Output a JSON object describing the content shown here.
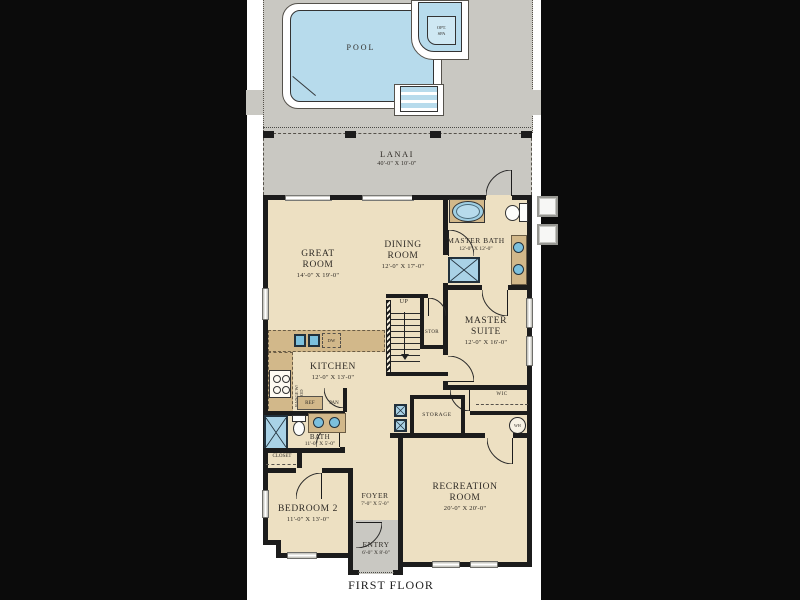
{
  "plan": {
    "title": "FIRST FLOOR"
  },
  "pool_area": {
    "pool_label": "POOL",
    "spa_label": "OPT. SPA"
  },
  "rooms": {
    "lanai": {
      "name": "LANAI",
      "dims": "40'-0\" X 10'-0\""
    },
    "great_room": {
      "name": "GREAT ROOM",
      "dims": "14'-0\" X 19'-0\""
    },
    "dining_room": {
      "name": "DINING ROOM",
      "dims": "12'-0\" X 17'-0\""
    },
    "master_bath": {
      "name": "MASTER BATH",
      "dims": "12'-0\" X 12'-0\""
    },
    "master_suite": {
      "name": "MASTER SUITE",
      "dims": "12'-0\" X 16'-0\""
    },
    "kitchen": {
      "name": "KITCHEN",
      "dims": "12'-0\" X 13'-0\""
    },
    "bath": {
      "name": "BATH",
      "dims": "11'-0\" X 5'-0\""
    },
    "bedroom2": {
      "name": "BEDROOM 2",
      "dims": "11'-0\" X 13'-0\""
    },
    "foyer": {
      "name": "FOYER",
      "dims": "7'-0\" X 5'-0\""
    },
    "entry": {
      "name": "ENTRY",
      "dims": "6'-0\" X 8'-0\""
    },
    "recreation_room": {
      "name": "RECREATION ROOM",
      "dims": "20'-0\" X 20'-0\""
    }
  },
  "annotations": {
    "up": "UP",
    "stor": "STOR",
    "storage": "STORAGE",
    "wic": "WIC",
    "wh": "WH",
    "closet": "CLOSET",
    "dw": "DW",
    "ref": "REF",
    "pan": "PAN",
    "range_hood": "RANGE W/ HOOD"
  },
  "colors": {
    "background": "#0b0b0b",
    "page": "#ffffff",
    "deck_gray": "#c9c8c2",
    "pool_water": "#b7dbec",
    "floor_cream": "#ede0c2",
    "wall_black": "#1c1c1c",
    "counter_tan": "#d2b88a",
    "fixture_blue": "#7cc0dd"
  }
}
